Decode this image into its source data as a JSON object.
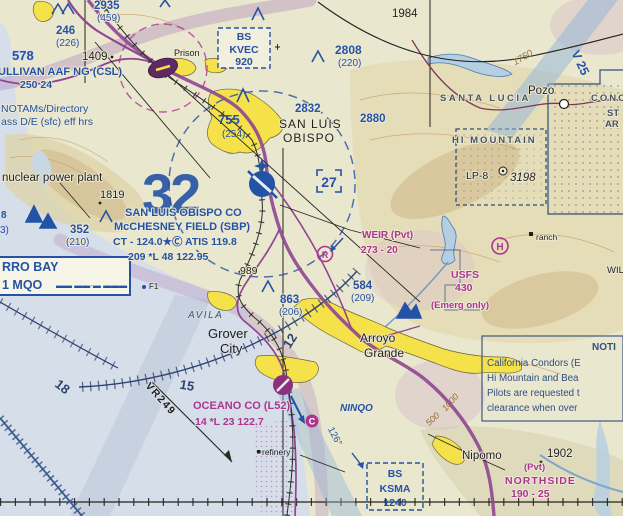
{
  "chart_title": "San Luis Obispo VFR Sectional Chart excerpt",
  "colors": {
    "aero_blue": "#2452a4",
    "aero_magenta": "#ad3591",
    "land": "#eae7cf",
    "water": "#d6dee9",
    "city_yellow": "#f5e14a",
    "road_purple": "#8f4691",
    "contour_brown": "#96713a"
  },
  "labels": {
    "obstructions": {
      "o2935": {
        "msl": "2935",
        "agl": "(459)"
      },
      "o246": {
        "msl": "246",
        "agl": "(226)"
      },
      "o2808": {
        "msl": "2808",
        "agl": "(220)"
      },
      "o755": {
        "msl": "755",
        "agl": "(254)"
      },
      "o352": {
        "msl": "352",
        "agl": "(210)"
      },
      "o863": {
        "msl": "863",
        "agl": "(206)"
      },
      "o584": {
        "msl": "584",
        "agl": "(209)"
      }
    },
    "airports": {
      "csl": {
        "name": "ULLIVAN AAF NG (CSL)",
        "data": "250    24"
      },
      "sbp": {
        "name1": "SAN LUIS OBISPO CO",
        "name2": "McCHESNEY FIELD (SBP)",
        "freqs": "CT - 124.0★Ⓒ ATIS 119.8",
        "data": "209 *L 48 122.95"
      },
      "oceano": {
        "name": "OCEANO CO (L52)",
        "data": "14 *L 23 122.7",
        "ctaf": "C"
      },
      "weir": {
        "name": "WEIR  (Pvt)",
        "data": "273 - 20",
        "symbol": "R"
      },
      "northside": {
        "pvt": "(Pvt)",
        "name": "NORTHSIDE",
        "data": "190 - 25"
      },
      "usfs": {
        "name": "USFS",
        "elev": "430",
        "note": "(Emerg only)"
      },
      "heliport": "H"
    },
    "navaids": {
      "kvec": {
        "l1": "BS",
        "l2": "KVEC",
        "l3": "920"
      },
      "ksma": {
        "l1": "BS",
        "l2": "KSMA",
        "l3": "1240"
      },
      "mqo": {
        "l1": "RRO BAY",
        "l2": "1 MQO",
        "morse": "▬▬ ▬▬·▬ ▬▬▬"
      }
    },
    "places": {
      "slo1": "SAN LUIS",
      "slo2": "OBISPO",
      "grover1": "Grover",
      "grover2": "City",
      "arroyo1": "Arroyo",
      "arroyo2": "Grande",
      "nipomo": "Nipomo",
      "pozo": "Pozo",
      "prison": "Prison",
      "avila": "AVILA",
      "santa_lucia": "SANTA LUCIA",
      "hi_mountain": "HI MOUNTAIN",
      "ranch": "ranch",
      "refinery": "refinery",
      "f1": "F1"
    },
    "elevations": {
      "e578": "578",
      "e1409": "1409",
      "e1819": "1819",
      "e989": "989",
      "e2832": "2832",
      "e2880": "2880",
      "e1984": "1984",
      "e1902": "1902",
      "peak": "LP-8",
      "peak_elev": "3198"
    },
    "notes": {
      "notams1": "NOTAMs/Directory",
      "notams2": "ass D/E (sfc) eff hrs",
      "nuclear": "nuclear power plant",
      "notice_title": "NOTI",
      "condor1": "California Condors (E",
      "condor2": "Hi Mountain and Bea",
      "condor3": "Pilots are requested t",
      "condor4": "clearance when over"
    },
    "airways": {
      "v25": "V 25",
      "vr249": "VR249",
      "fix": "NINQO",
      "radial": "126°"
    },
    "compass": {
      "c12": "12",
      "c15": "15",
      "c18": "18"
    },
    "mef": {
      "q32": "32",
      "q27": "27"
    },
    "contours": {
      "c1750": "1750",
      "c1000": "1000",
      "c500": "500"
    },
    "edge": {
      "conc": "CONC",
      "st": "ST",
      "ar": "AR",
      "wil": "WIL",
      "p8": "8",
      "p3": "3)"
    }
  }
}
